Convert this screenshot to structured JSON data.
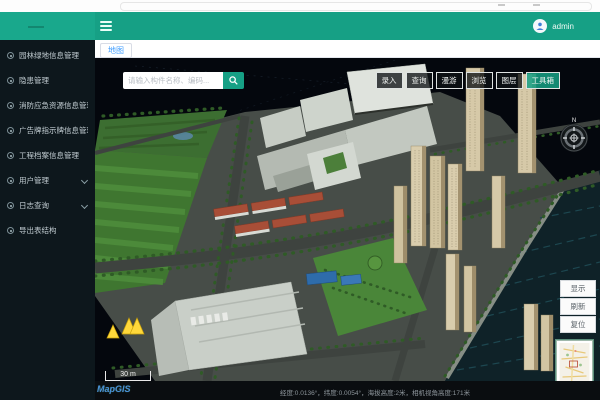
{
  "header": {
    "user_name": "admin"
  },
  "sidebar": {
    "items": [
      {
        "label": "园林绿地信息管理",
        "expandable": false
      },
      {
        "label": "隐患管理",
        "expandable": false
      },
      {
        "label": "消防应急资源信息管理",
        "expandable": false
      },
      {
        "label": "广告牌指示牌信息管理",
        "expandable": false
      },
      {
        "label": "工程档案信息管理",
        "expandable": false
      },
      {
        "label": "用户管理",
        "expandable": true
      },
      {
        "label": "日志查询",
        "expandable": true
      },
      {
        "label": "导出表结构",
        "expandable": false
      }
    ]
  },
  "tabs": {
    "active": "地图"
  },
  "map": {
    "search_placeholder": "请输入构件名称、编码...",
    "toolbar": {
      "buttons": [
        "录入",
        "查询",
        "漫游",
        "浏览",
        "图层",
        "工具箱"
      ]
    },
    "side_buttons": [
      "显示",
      "刷新",
      "复位"
    ],
    "compass_north": "N",
    "scale_label": "30 m",
    "brand": "MapGIS",
    "status_text": "经度:0.0136°，纬度:0.0054°，海拔高度:2米，相机视角高度:171米"
  },
  "colors": {
    "accent": "#16a085",
    "tab_active": "#409eff",
    "warning": "#ffd83b"
  }
}
